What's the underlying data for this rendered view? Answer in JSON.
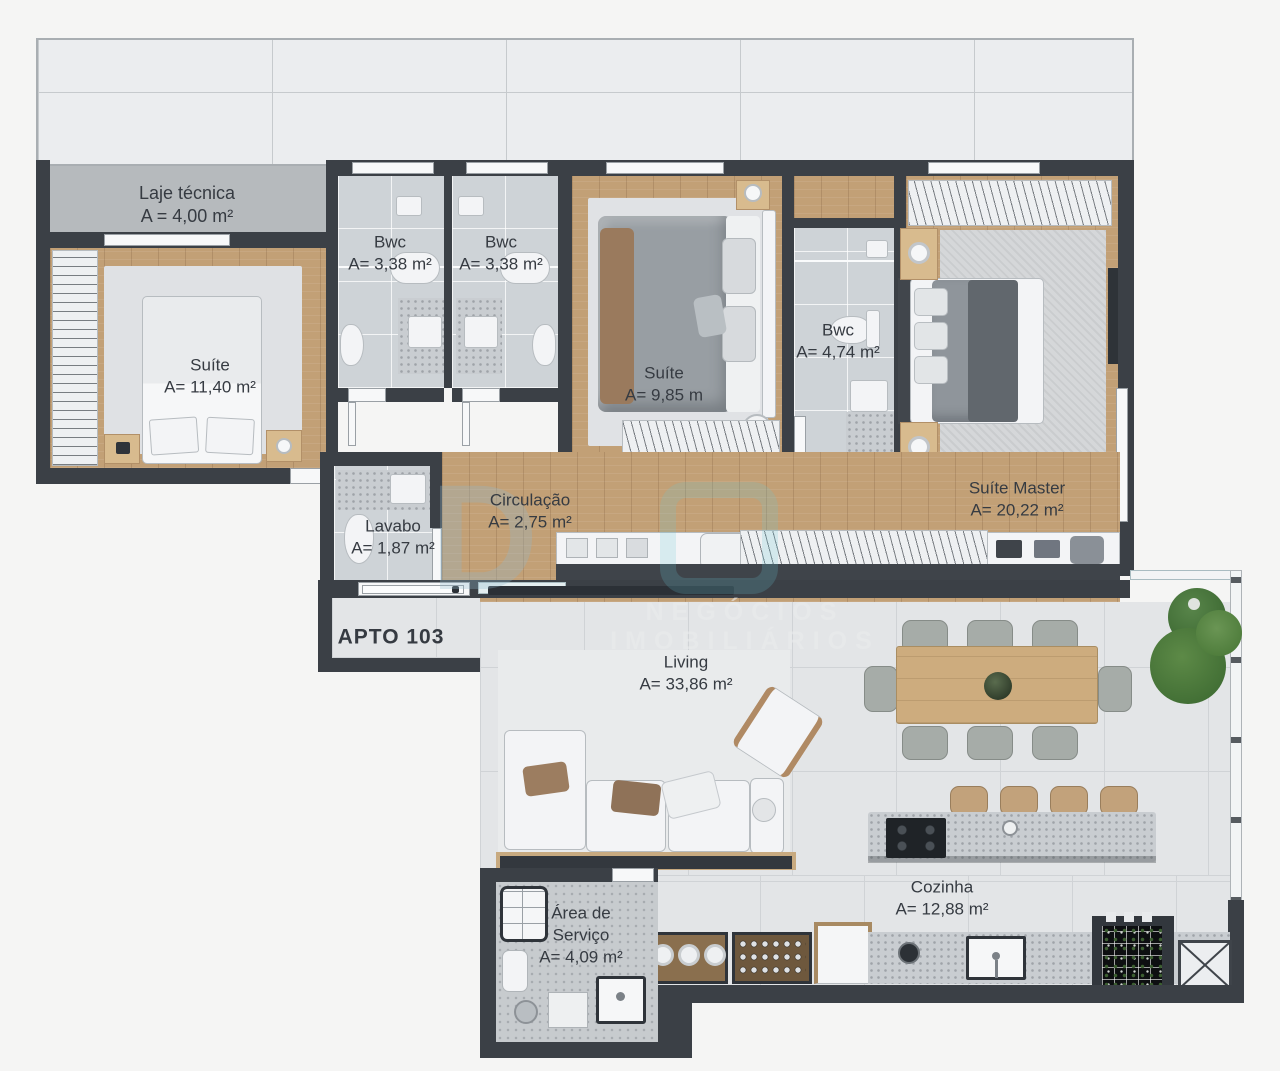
{
  "apartment_label": "APTO 103",
  "watermark": {
    "logo": "D",
    "subtitle": "NEGÓCIOS IMOBILIÁRIOS"
  },
  "colors": {
    "wall": "#3b4046",
    "wood_floor": "#c2a076",
    "bath_tile": "#ced3d7",
    "living_tile": "#e3e5e7",
    "concrete_slab": "#b6babd",
    "plant_green": "#4f7d3c"
  },
  "rooms": [
    {
      "id": "laje-tecnica",
      "name": "Laje técnica",
      "area": "A = 4,00 m²"
    },
    {
      "id": "suite-1",
      "name": "Suíte",
      "area": "A= 11,40 m²"
    },
    {
      "id": "bwc-1",
      "name": "Bwc",
      "area": "A= 3,38 m²"
    },
    {
      "id": "bwc-2",
      "name": "Bwc",
      "area": "A= 3,38 m²"
    },
    {
      "id": "suite-2",
      "name": "Suíte",
      "area": "A= 9,85 m"
    },
    {
      "id": "bwc-3",
      "name": "Bwc",
      "area": "A= 4,74 m²"
    },
    {
      "id": "suite-master",
      "name": "Suíte Master",
      "area": "A= 20,22 m²"
    },
    {
      "id": "lavabo",
      "name": "Lavabo",
      "area": "A= 1,87 m²"
    },
    {
      "id": "circulacao",
      "name": "Circulação",
      "area": "A= 2,75 m²"
    },
    {
      "id": "living",
      "name": "Living",
      "area": "A= 33,86 m²"
    },
    {
      "id": "cozinha",
      "name": "Cozinha",
      "area": "A= 12,88 m²"
    },
    {
      "id": "area-servico",
      "name": "Área de Serviço",
      "area": "A= 4,09 m²"
    }
  ]
}
